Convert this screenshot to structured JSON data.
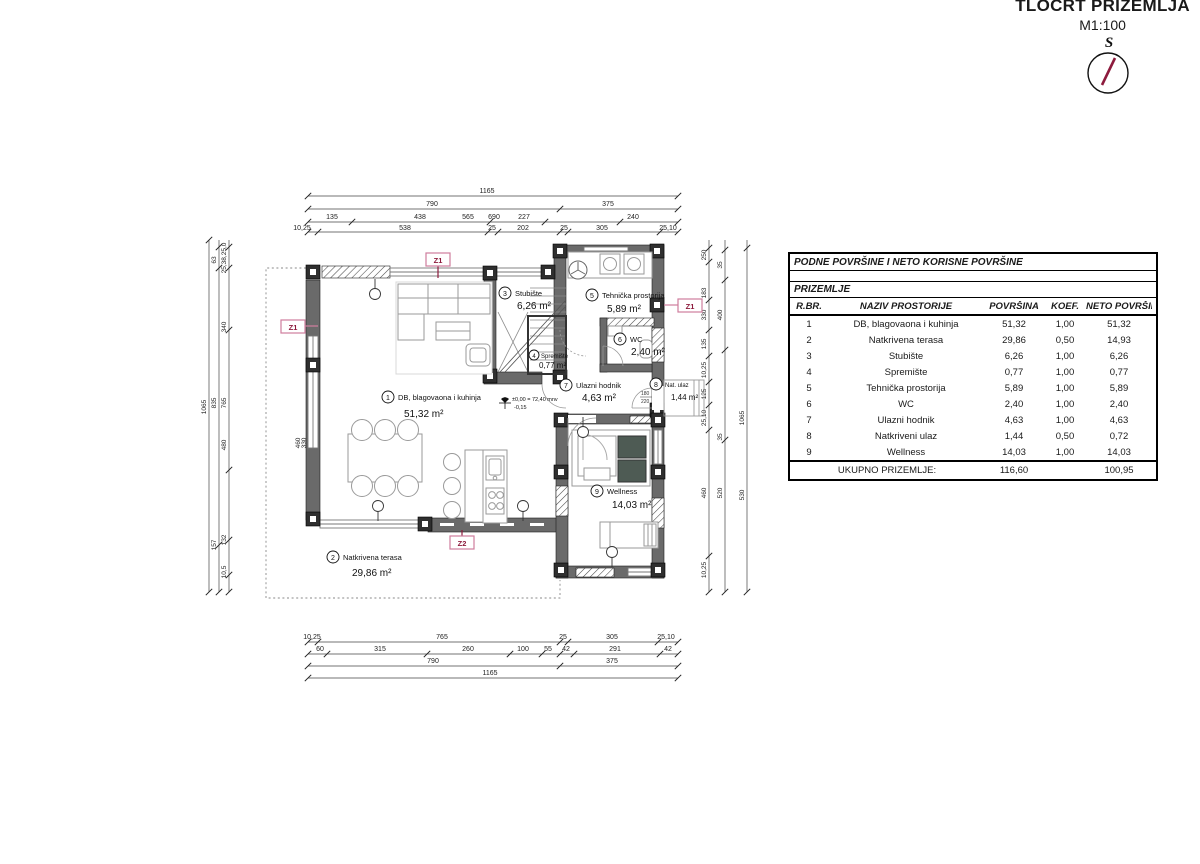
{
  "title_block": {
    "title": "TLOCRT PRIZEMLJA",
    "scale": "M1:100",
    "north_label": "S"
  },
  "table": {
    "title": "PODNE POVRŠINE I NETO KORISNE POVRŠINE",
    "section": "PRIZEMLJE",
    "columns": {
      "num": "R.BR.",
      "name": "NAZIV PROSTORIJE",
      "area": "POVRŠINA",
      "koef": "KOEF.",
      "net": "NETO POVRŠINA"
    },
    "rows": [
      {
        "num": "1",
        "name": "DB, blagovaona i kuhinja",
        "area": "51,32",
        "koef": "1,00",
        "net": "51,32"
      },
      {
        "num": "2",
        "name": "Natkrivena terasa",
        "area": "29,86",
        "koef": "0,50",
        "net": "14,93"
      },
      {
        "num": "3",
        "name": "Stubište",
        "area": "6,26",
        "koef": "1,00",
        "net": "6,26"
      },
      {
        "num": "4",
        "name": "Spremište",
        "area": "0,77",
        "koef": "1,00",
        "net": "0,77"
      },
      {
        "num": "5",
        "name": "Tehnička prostorija",
        "area": "5,89",
        "koef": "1,00",
        "net": "5,89"
      },
      {
        "num": "6",
        "name": "WC",
        "area": "2,40",
        "koef": "1,00",
        "net": "2,40"
      },
      {
        "num": "7",
        "name": "Ulazni hodnik",
        "area": "4,63",
        "koef": "1,00",
        "net": "4,63"
      },
      {
        "num": "8",
        "name": "Natkriveni ulaz",
        "area": "1,44",
        "koef": "0,50",
        "net": "0,72"
      },
      {
        "num": "9",
        "name": "Wellness",
        "area": "14,03",
        "koef": "1,00",
        "net": "14,03"
      }
    ],
    "total": {
      "label": "UKUPNO PRIZEMLJE:",
      "area": "116,60",
      "net": "100,95"
    }
  },
  "plan": {
    "rooms": [
      {
        "num": "1",
        "name": "DB, blagovaona i kuhinja",
        "area": "51,32 m²"
      },
      {
        "num": "2",
        "name": "Natkrivena terasa",
        "area": "29,86 m²"
      },
      {
        "num": "3",
        "name": "Stubište",
        "area": "6,26 m²"
      },
      {
        "num": "4",
        "name": "Spremište",
        "area": "0,77 m²"
      },
      {
        "num": "5",
        "name": "Tehnička prostorija",
        "area": "5,89 m²"
      },
      {
        "num": "6",
        "name": "WC",
        "area": "2,40 m²"
      },
      {
        "num": "7",
        "name": "Ulazni hodnik",
        "area": "4,63 m²"
      },
      {
        "num": "8",
        "name": "Nat. ulaz",
        "area": "1,44 m²"
      },
      {
        "num": "9",
        "name": "Wellness",
        "area": "14,03 m²"
      }
    ],
    "markers": {
      "z1": "Z1",
      "z2": "Z2"
    },
    "elevation": {
      "line1": "±0,00 = 72,40 mnv",
      "line2": "-0,15"
    },
    "door_tag": {
      "w": "180",
      "h": "220"
    },
    "wall_tag": {
      "a": "460",
      "b": "330"
    },
    "dims": {
      "top1": "1165",
      "top2": [
        "790",
        "375"
      ],
      "top3": [
        "135",
        "438",
        "565",
        "690",
        "227",
        "240"
      ],
      "top4": [
        "10,25",
        "538",
        "25",
        "202",
        "25",
        "305",
        "25,10"
      ],
      "bottom1": [
        "10,25",
        "765",
        "25",
        "305",
        "25,10"
      ],
      "bottom2": [
        "60",
        "315",
        "260",
        "100",
        "55",
        "42",
        "291",
        "42"
      ],
      "bottom3": [
        "790",
        "375"
      ],
      "bottom4": "1165",
      "left1": "1065",
      "left2": [
        "63",
        "835",
        "157"
      ],
      "left3": [
        "25,38,25,0",
        "340",
        "765",
        "480",
        "132",
        "10,5"
      ],
      "right1": [
        "250",
        "183",
        "330",
        "135",
        "10,25",
        "125",
        "25,10",
        "460",
        "10,25"
      ],
      "right2": [
        "35",
        "400",
        "35",
        "520"
      ],
      "right3": [
        "1065",
        "530"
      ]
    }
  },
  "colors": {
    "wall": "#6a6a6a",
    "column": "#2f2f2f",
    "marker_red": "#8d1b3d",
    "marker_pink": "#cf7d9d",
    "sauna_block": "#4e5b54"
  }
}
